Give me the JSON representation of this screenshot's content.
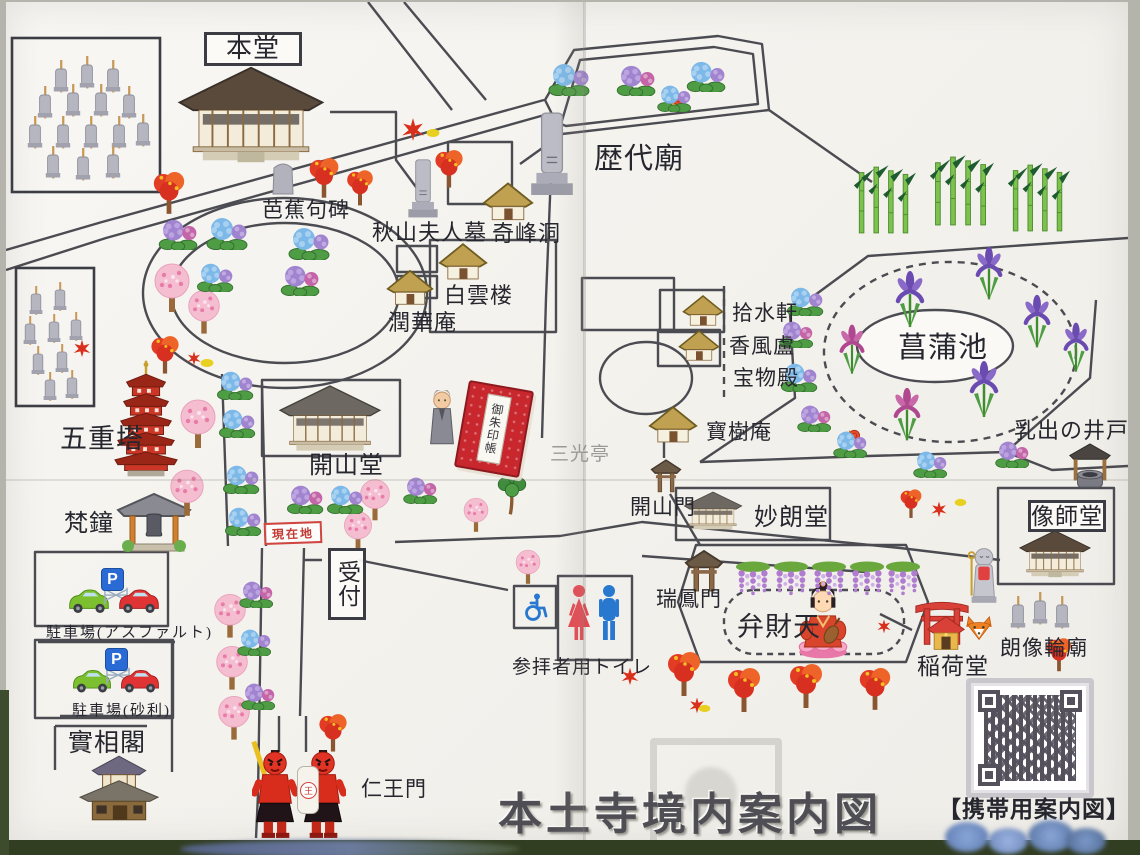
{
  "title": "本土寺境内案内図",
  "qr_caption": "【携帯用案内図】",
  "you_are_here": "現在地",
  "parking_sign": "P",
  "nio_lantern": "王",
  "places": {
    "main_hall": "本堂",
    "rekidai_mausoleum": "歴代廟",
    "basho_haiku_stone": "芭蕉句碑",
    "akiyama_wife_grave": "秋山夫人墓",
    "kiho_cave": "奇峰洞",
    "hakuun_ro": "白雲楼",
    "junka_an": "潤華庵",
    "jusui_ken": "拾水軒",
    "kofu_ro": "香風盧",
    "treasure_hall": "宝物殿",
    "iris_pond": "菖蒲池",
    "five_story_pagoda": "五重塔",
    "kaisan_do": "開山堂",
    "sanko_tei": "三光亭",
    "hoju_an": "寶樹庵",
    "milk_well": "乳出の井戸",
    "kaisan_mon": "開山門",
    "myoro_do": "妙朗堂",
    "zoshi_do": "像師堂",
    "temple_bell": "梵鐘",
    "reception": "受付",
    "zuiho_mon": "瑞鳳門",
    "benzaiten": "弁財天",
    "inari_do": "稲荷堂",
    "rozo_rinbyo": "朗像輪廟",
    "parking_asphalt": "駐車場(アスファルト)",
    "parking_gravel": "駐車場(砂利)",
    "jisso_kaku": "實相閣",
    "nio_mon": "仁王門",
    "visitor_toilet": "参拝者用トイレ",
    "goshuincho": "御朱印帳"
  },
  "colors": {
    "path": "#4b4b52",
    "stamp_red": "#c33a34",
    "torii_red": "#d84038"
  }
}
